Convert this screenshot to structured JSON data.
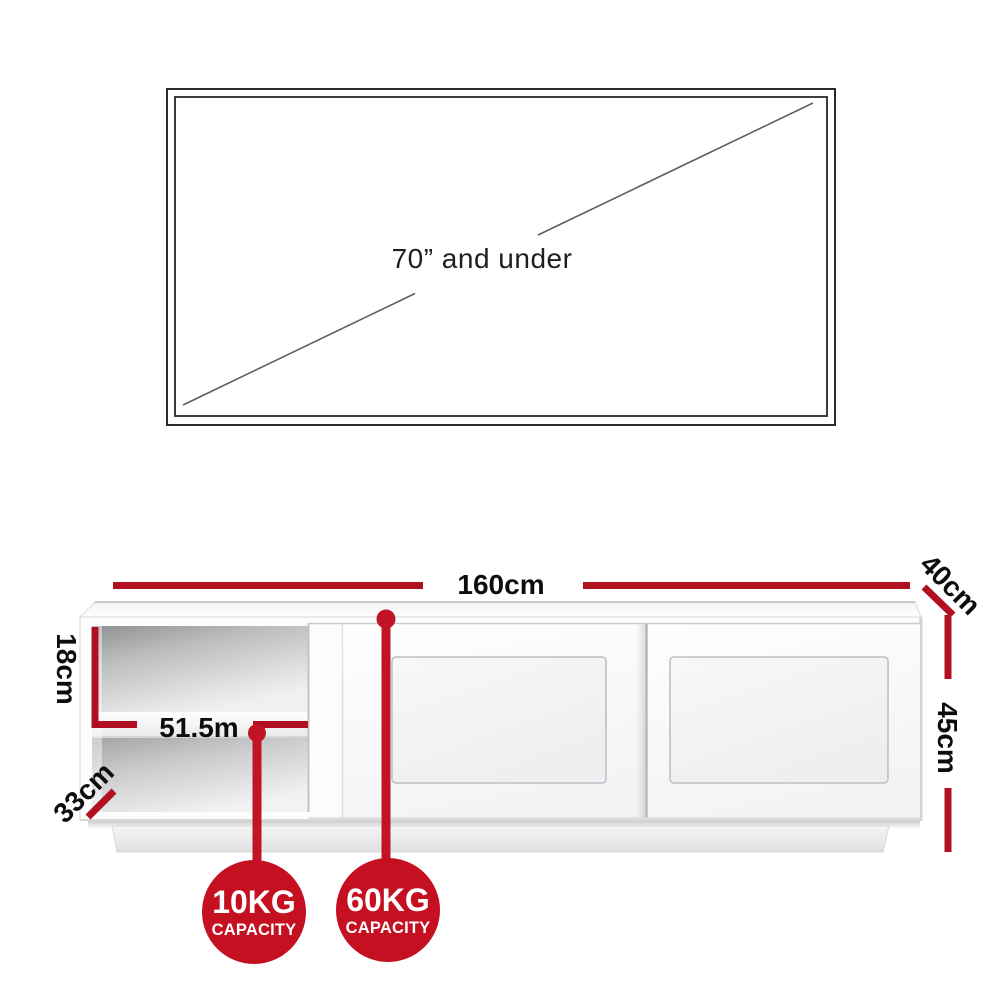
{
  "tv": {
    "label": "70” and under"
  },
  "cabinet": {
    "width_label": "160cm",
    "depth_label": "40cm",
    "height_label": "45cm",
    "compartment_height_label": "18cm",
    "compartment_depth_label": "33cm",
    "shelf_width_label": "51.5m"
  },
  "badges": [
    {
      "weight": "10KG",
      "label": "CAPACITY"
    },
    {
      "weight": "60KG",
      "label": "CAPACITY"
    }
  ],
  "colors": {
    "dimension_red": "#b01020",
    "leader_red": "#c11425",
    "badge_red": "#c51022",
    "text_black": "#111111"
  }
}
